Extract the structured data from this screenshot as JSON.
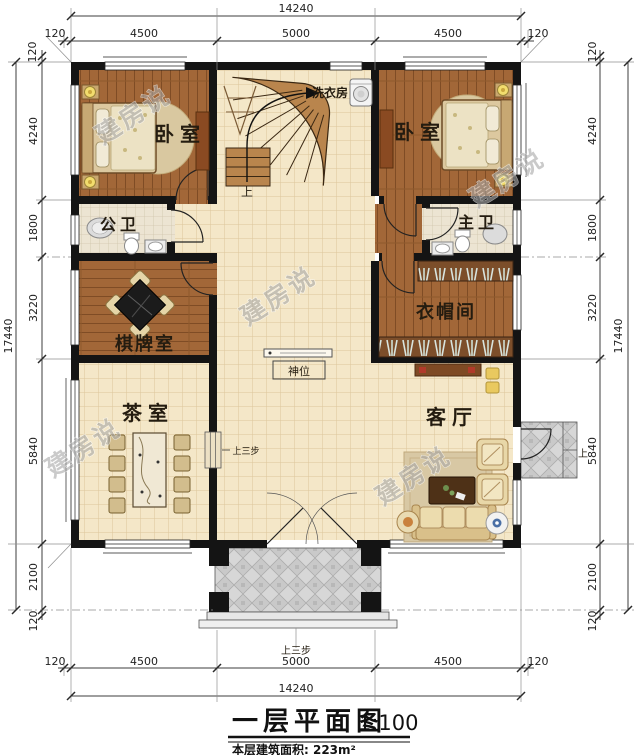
{
  "watermark": {
    "text": "建房说"
  },
  "title": {
    "main": "一层平面图",
    "scale": "1:100",
    "area": "本层建筑面积: 223m²"
  },
  "rooms": {
    "bedroom_left": "卧室",
    "bedroom_right": "卧室",
    "laundry": "洗衣房",
    "public_bath": "公卫",
    "master_bath": "主卫",
    "chess_room": "棋牌室",
    "cloak_room": "衣帽间",
    "tea_room": "茶室",
    "living_room": "客厅",
    "shrine": "神位"
  },
  "annotations": {
    "up": "上",
    "up_three_steps": "上三步"
  },
  "dims": {
    "top": {
      "total": "14240",
      "segments": [
        "120",
        "4500",
        "5000",
        "4500",
        "120"
      ]
    },
    "bottom": {
      "total": "14240",
      "segments": [
        "120",
        "4500",
        "5000",
        "4500",
        "120"
      ]
    },
    "left": {
      "total": "17440",
      "segments": [
        "120",
        "4240",
        "1800",
        "3220",
        "5840",
        "2100",
        "120"
      ]
    },
    "right": {
      "total": "17440",
      "segments": [
        "120",
        "4240",
        "1800",
        "3220",
        "5840",
        "2100",
        "120"
      ]
    }
  },
  "colors": {
    "wall": "#141414",
    "wood": "#a26738",
    "tile": "#f4e7c8",
    "porch": "#d7d7d7",
    "stair": "#b9854d"
  }
}
